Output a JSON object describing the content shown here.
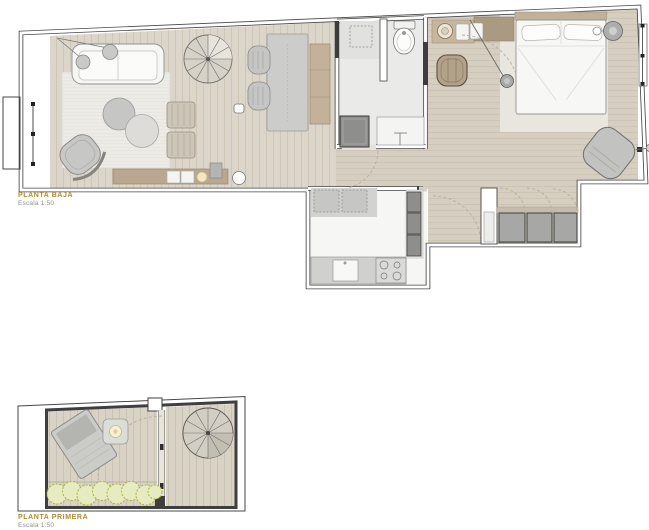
{
  "sheet": {
    "background": "#ffffff"
  },
  "plans": {
    "ground": {
      "title": "PLANTA BAJA",
      "scale": "Escala 1:50"
    },
    "first": {
      "title": "PLANTA PRIMERA",
      "scale": "Escala 1:50"
    }
  },
  "palette": {
    "accent_label": "#ad8b2e",
    "scale_text": "#8f8f8f",
    "wall_line": "#474747",
    "wood_floor": "#dcd5c9",
    "wood_floor_warm": "#d6cec0",
    "tile_floor": "#eaeae8",
    "kitchen_floor": "#f6f6f5",
    "furniture_gray": "#c6c6c4",
    "furniture_dark": "#8e8e8c",
    "furniture_tan": "#b9a78f",
    "plant_green": "#a9b23c"
  }
}
